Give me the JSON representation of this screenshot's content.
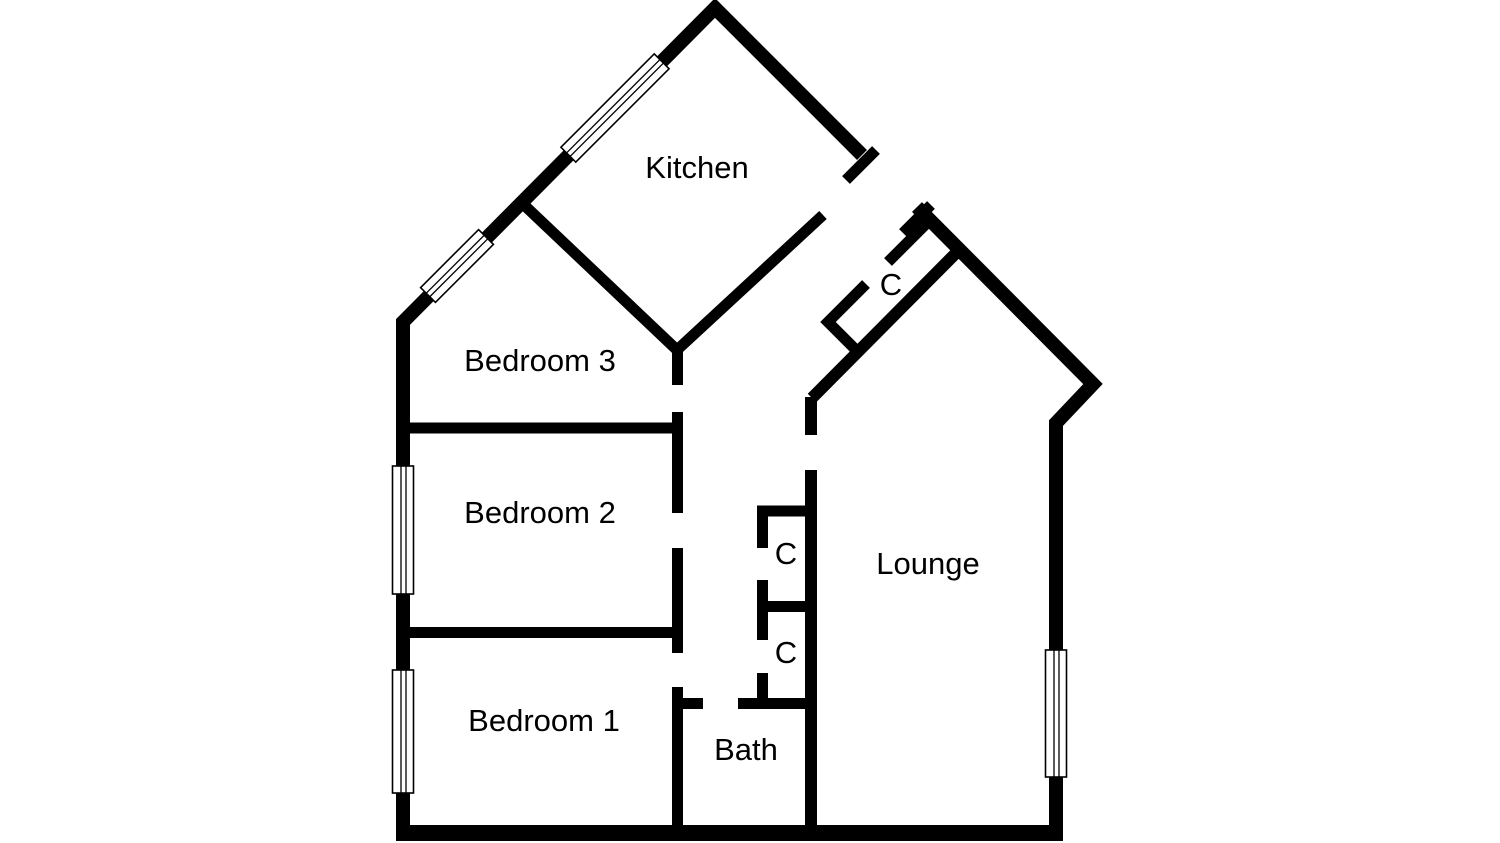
{
  "page": {
    "background_color": "#ffffff",
    "wall_color": "#000000",
    "label_color": "#000000"
  },
  "floor_plan": {
    "rooms": [
      {
        "name": "kitchen",
        "label": "Kitchen"
      },
      {
        "name": "bedroom-3",
        "label": "Bedroom 3"
      },
      {
        "name": "bedroom-2",
        "label": "Bedroom 2"
      },
      {
        "name": "bedroom-1",
        "label": "Bedroom 1"
      },
      {
        "name": "bath",
        "label": "Bath"
      },
      {
        "name": "lounge",
        "label": "Lounge"
      }
    ],
    "closets": [
      {
        "name": "closet-entrance",
        "label": "C"
      },
      {
        "name": "closet-hall-upper",
        "label": "C"
      },
      {
        "name": "closet-hall-lower",
        "label": "C"
      }
    ],
    "window_count": 5
  }
}
